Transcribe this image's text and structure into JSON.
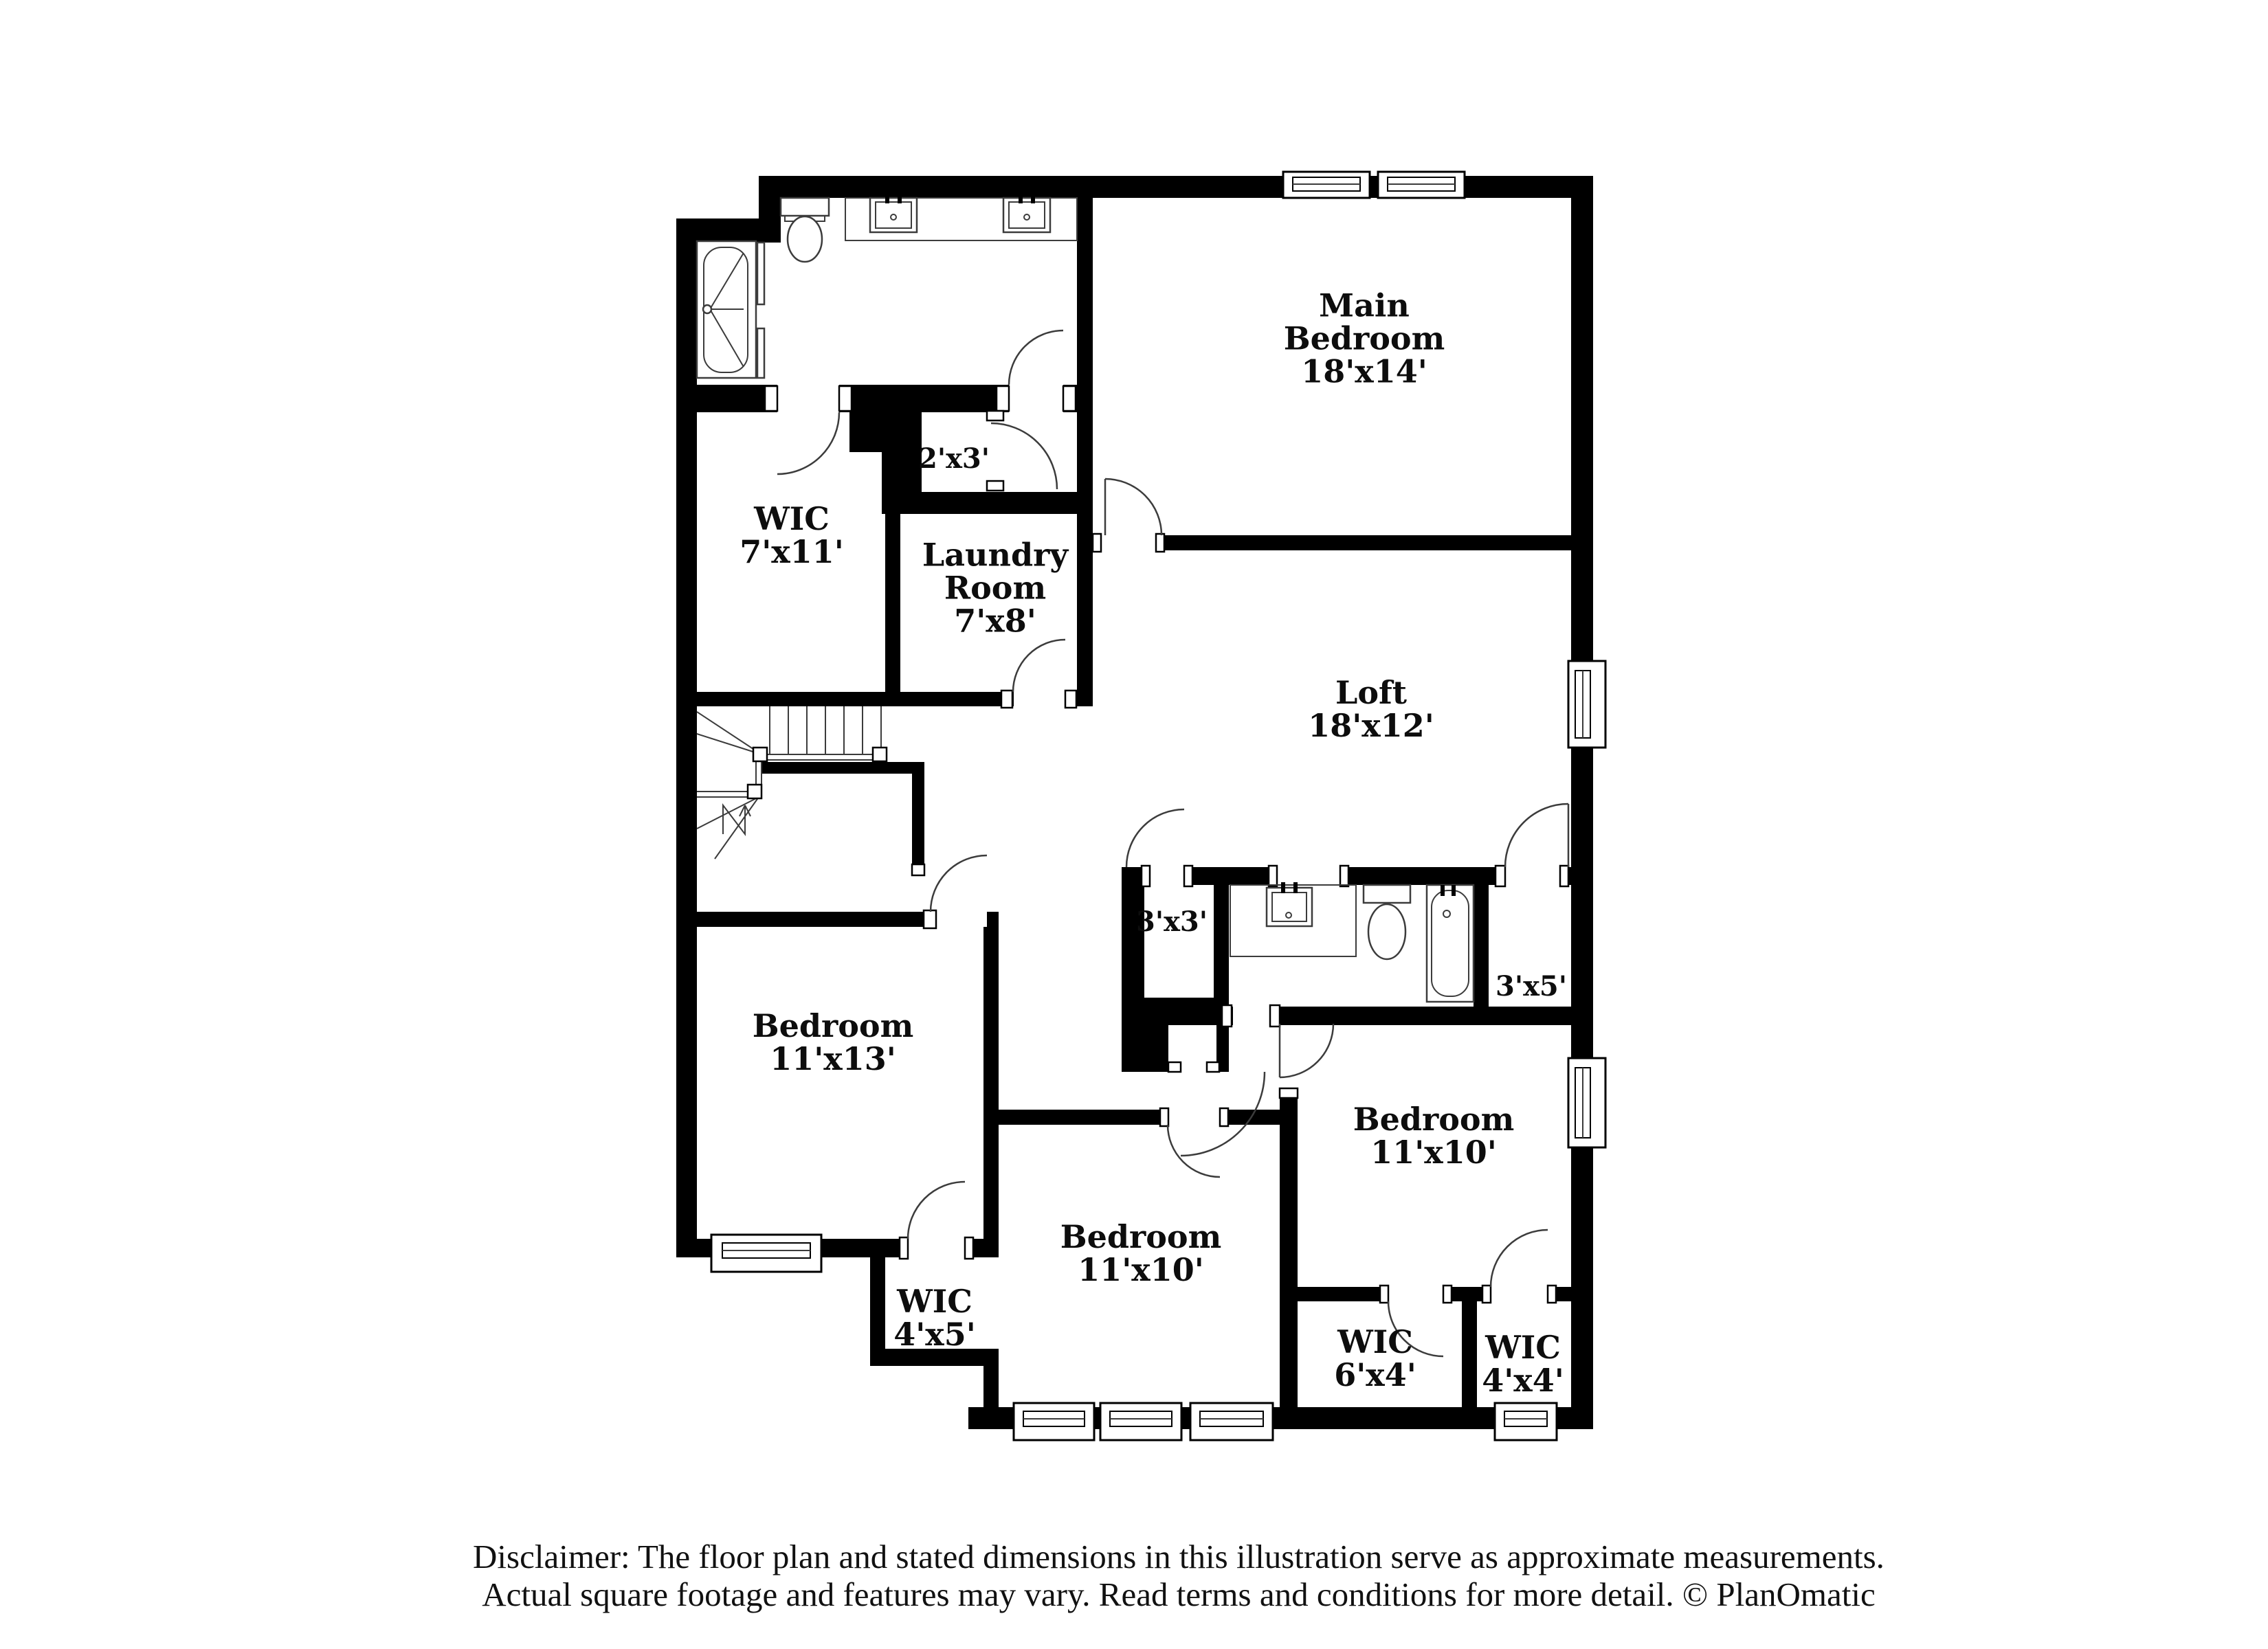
{
  "page": {
    "background": "#ffffff"
  },
  "colors": {
    "wall": "#000000",
    "fixture_line": "#3c3c3c",
    "label_text": "#0d0d0d"
  },
  "rooms": [
    {
      "name": "Main Bedroom",
      "dims": "18'x14'"
    },
    {
      "name": "WIC",
      "dims": "7'x11'"
    },
    {
      "name": "Laundry Room",
      "dims": "7'x8'"
    },
    {
      "name": "",
      "dims": "2'x3'"
    },
    {
      "name": "Loft",
      "dims": "18'x12'"
    },
    {
      "name": "",
      "dims": "3'x3'"
    },
    {
      "name": "",
      "dims": "3'x5'"
    },
    {
      "name": "Bedroom",
      "dims": "11'x13'"
    },
    {
      "name": "Bedroom",
      "dims": "11'x10'"
    },
    {
      "name": "Bedroom",
      "dims": "11'x10'"
    },
    {
      "name": "WIC",
      "dims": "4'x5'"
    },
    {
      "name": "WIC",
      "dims": "6'x4'"
    },
    {
      "name": "WIC",
      "dims": "4'x4'"
    }
  ],
  "fixtures": [
    "shower",
    "toilet",
    "vanity-sink",
    "vanity-sink",
    "bathtub",
    "toilet",
    "vanity-sink",
    "stairs"
  ],
  "disclaimer": {
    "line1": "Disclaimer: The floor plan and stated dimensions in this illustration serve as approximate measurements.",
    "line2": "Actual square footage and features may vary. Read terms and conditions for more detail. © PlanOmatic"
  }
}
